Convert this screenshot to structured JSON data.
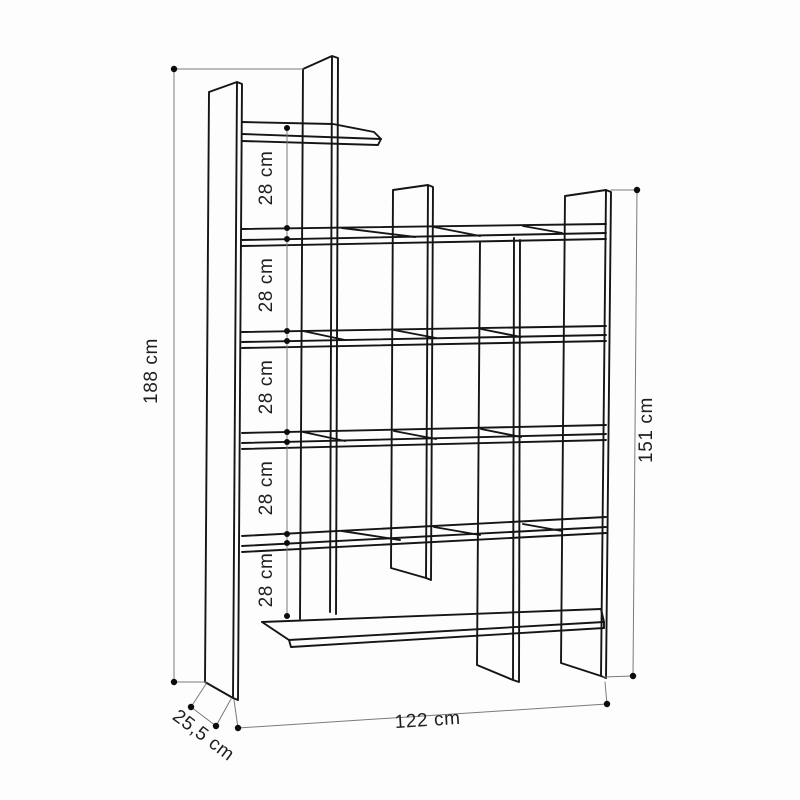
{
  "diagram": {
    "title": "Bookcase dimension drawing",
    "subject": "staggered asymmetric bookcase line drawing",
    "colors": {
      "outline": "#151515",
      "dimension_line": "#7a7a7a",
      "label_text": "#1f1f1f",
      "background": "#fdfdfd"
    },
    "dimensions": {
      "total_height": {
        "label": "188 cm"
      },
      "right_height": {
        "label": "151 cm"
      },
      "width": {
        "label": "122 cm"
      },
      "depth": {
        "label": "25,5 cm"
      },
      "shelf_gaps": [
        {
          "label": "28 cm"
        },
        {
          "label": "28 cm"
        },
        {
          "label": "28 cm"
        },
        {
          "label": "28 cm"
        },
        {
          "label": "28 cm"
        }
      ]
    }
  }
}
